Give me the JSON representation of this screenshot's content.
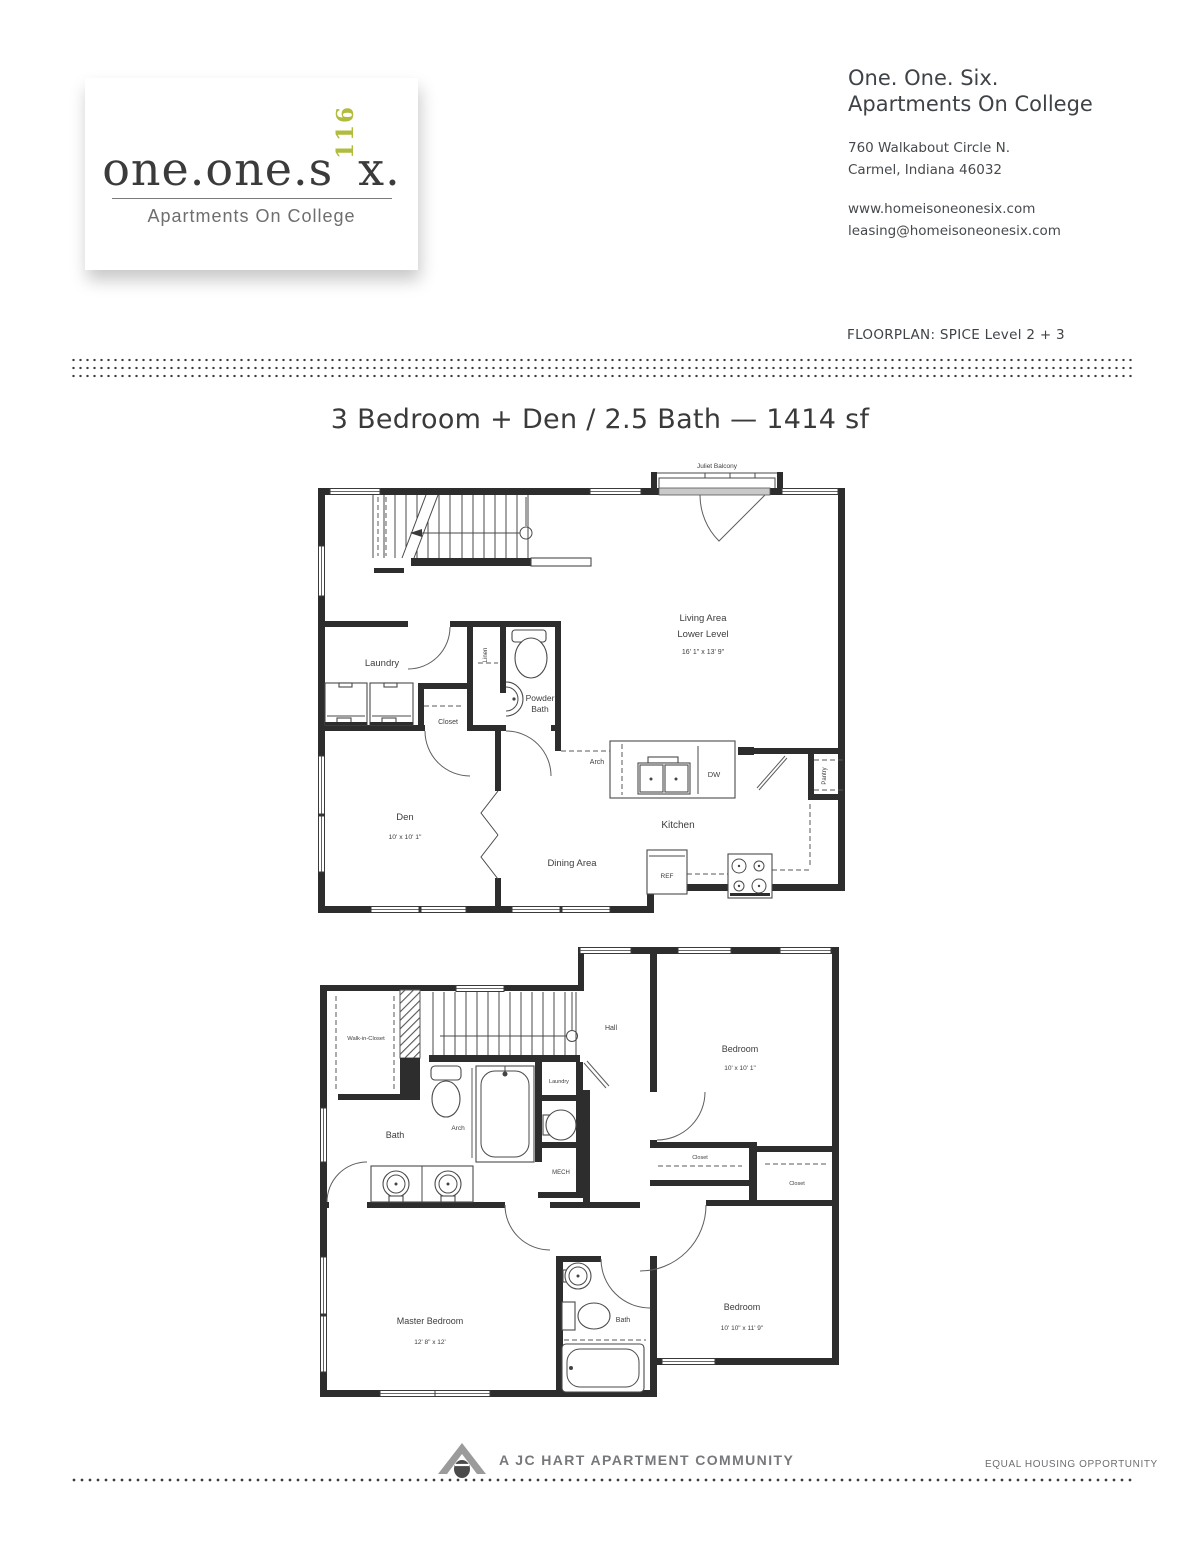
{
  "logo": {
    "word_start": "one.one.s",
    "vertical_number": "116",
    "word_end": "x.",
    "tagline": "Apartments On College"
  },
  "header": {
    "title_line1": "One. One. Six.",
    "title_line2": "Apartments On College",
    "address_line1": "760 Walkabout Circle N.",
    "address_line2": "Carmel, Indiana 46032",
    "website": "www.homeisoneonesix.com",
    "email": "leasing@homeisoneonesix.com"
  },
  "floorplan_label": "FLOORPLAN: SPICE Level 2 + 3",
  "plan_title": "3 Bedroom + Den / 2.5 Bath — 1414 sf",
  "level2": {
    "juliet_balcony": "Juliet Balcony",
    "living_area_line1": "Living Area",
    "living_area_line2": "Lower Level",
    "living_area_dim": "16' 1\" x 13' 9\"",
    "laundry": "Laundry",
    "linen": "Linen",
    "powder_line1": "Powder",
    "powder_line2": "Bath",
    "closet": "Closet",
    "arch": "Arch",
    "dw": "DW",
    "pantry": "Pantry",
    "den": "Den",
    "den_dim": "10' x 10' 1\"",
    "kitchen": "Kitchen",
    "dining": "Dining Area",
    "ref": "REF"
  },
  "level3": {
    "walk_in_closet": "Walk-in-Closet",
    "hall": "Hall",
    "bedroom1": "Bedroom",
    "bedroom1_dim": "10' x 10' 1\"",
    "laundry": "Laundry",
    "bath": "Bath",
    "arch": "Arch",
    "mech": "MECH",
    "closet1": "Closet",
    "closet2": "Closet",
    "master": "Master Bedroom",
    "master_dim": "12' 8\" x 12'",
    "bath2": "Bath",
    "bedroom2": "Bedroom",
    "bedroom2_dim": "10' 10\" x 11' 9\""
  },
  "footer": {
    "community": "A JC HART APARTMENT COMMUNITY",
    "equal_housing": "EQUAL HOUSING OPPORTUNITY"
  },
  "colors": {
    "accent": "#b2bc3c",
    "wall": "#2d2d2d",
    "text": "#3f4347",
    "gray": "#77787b"
  }
}
